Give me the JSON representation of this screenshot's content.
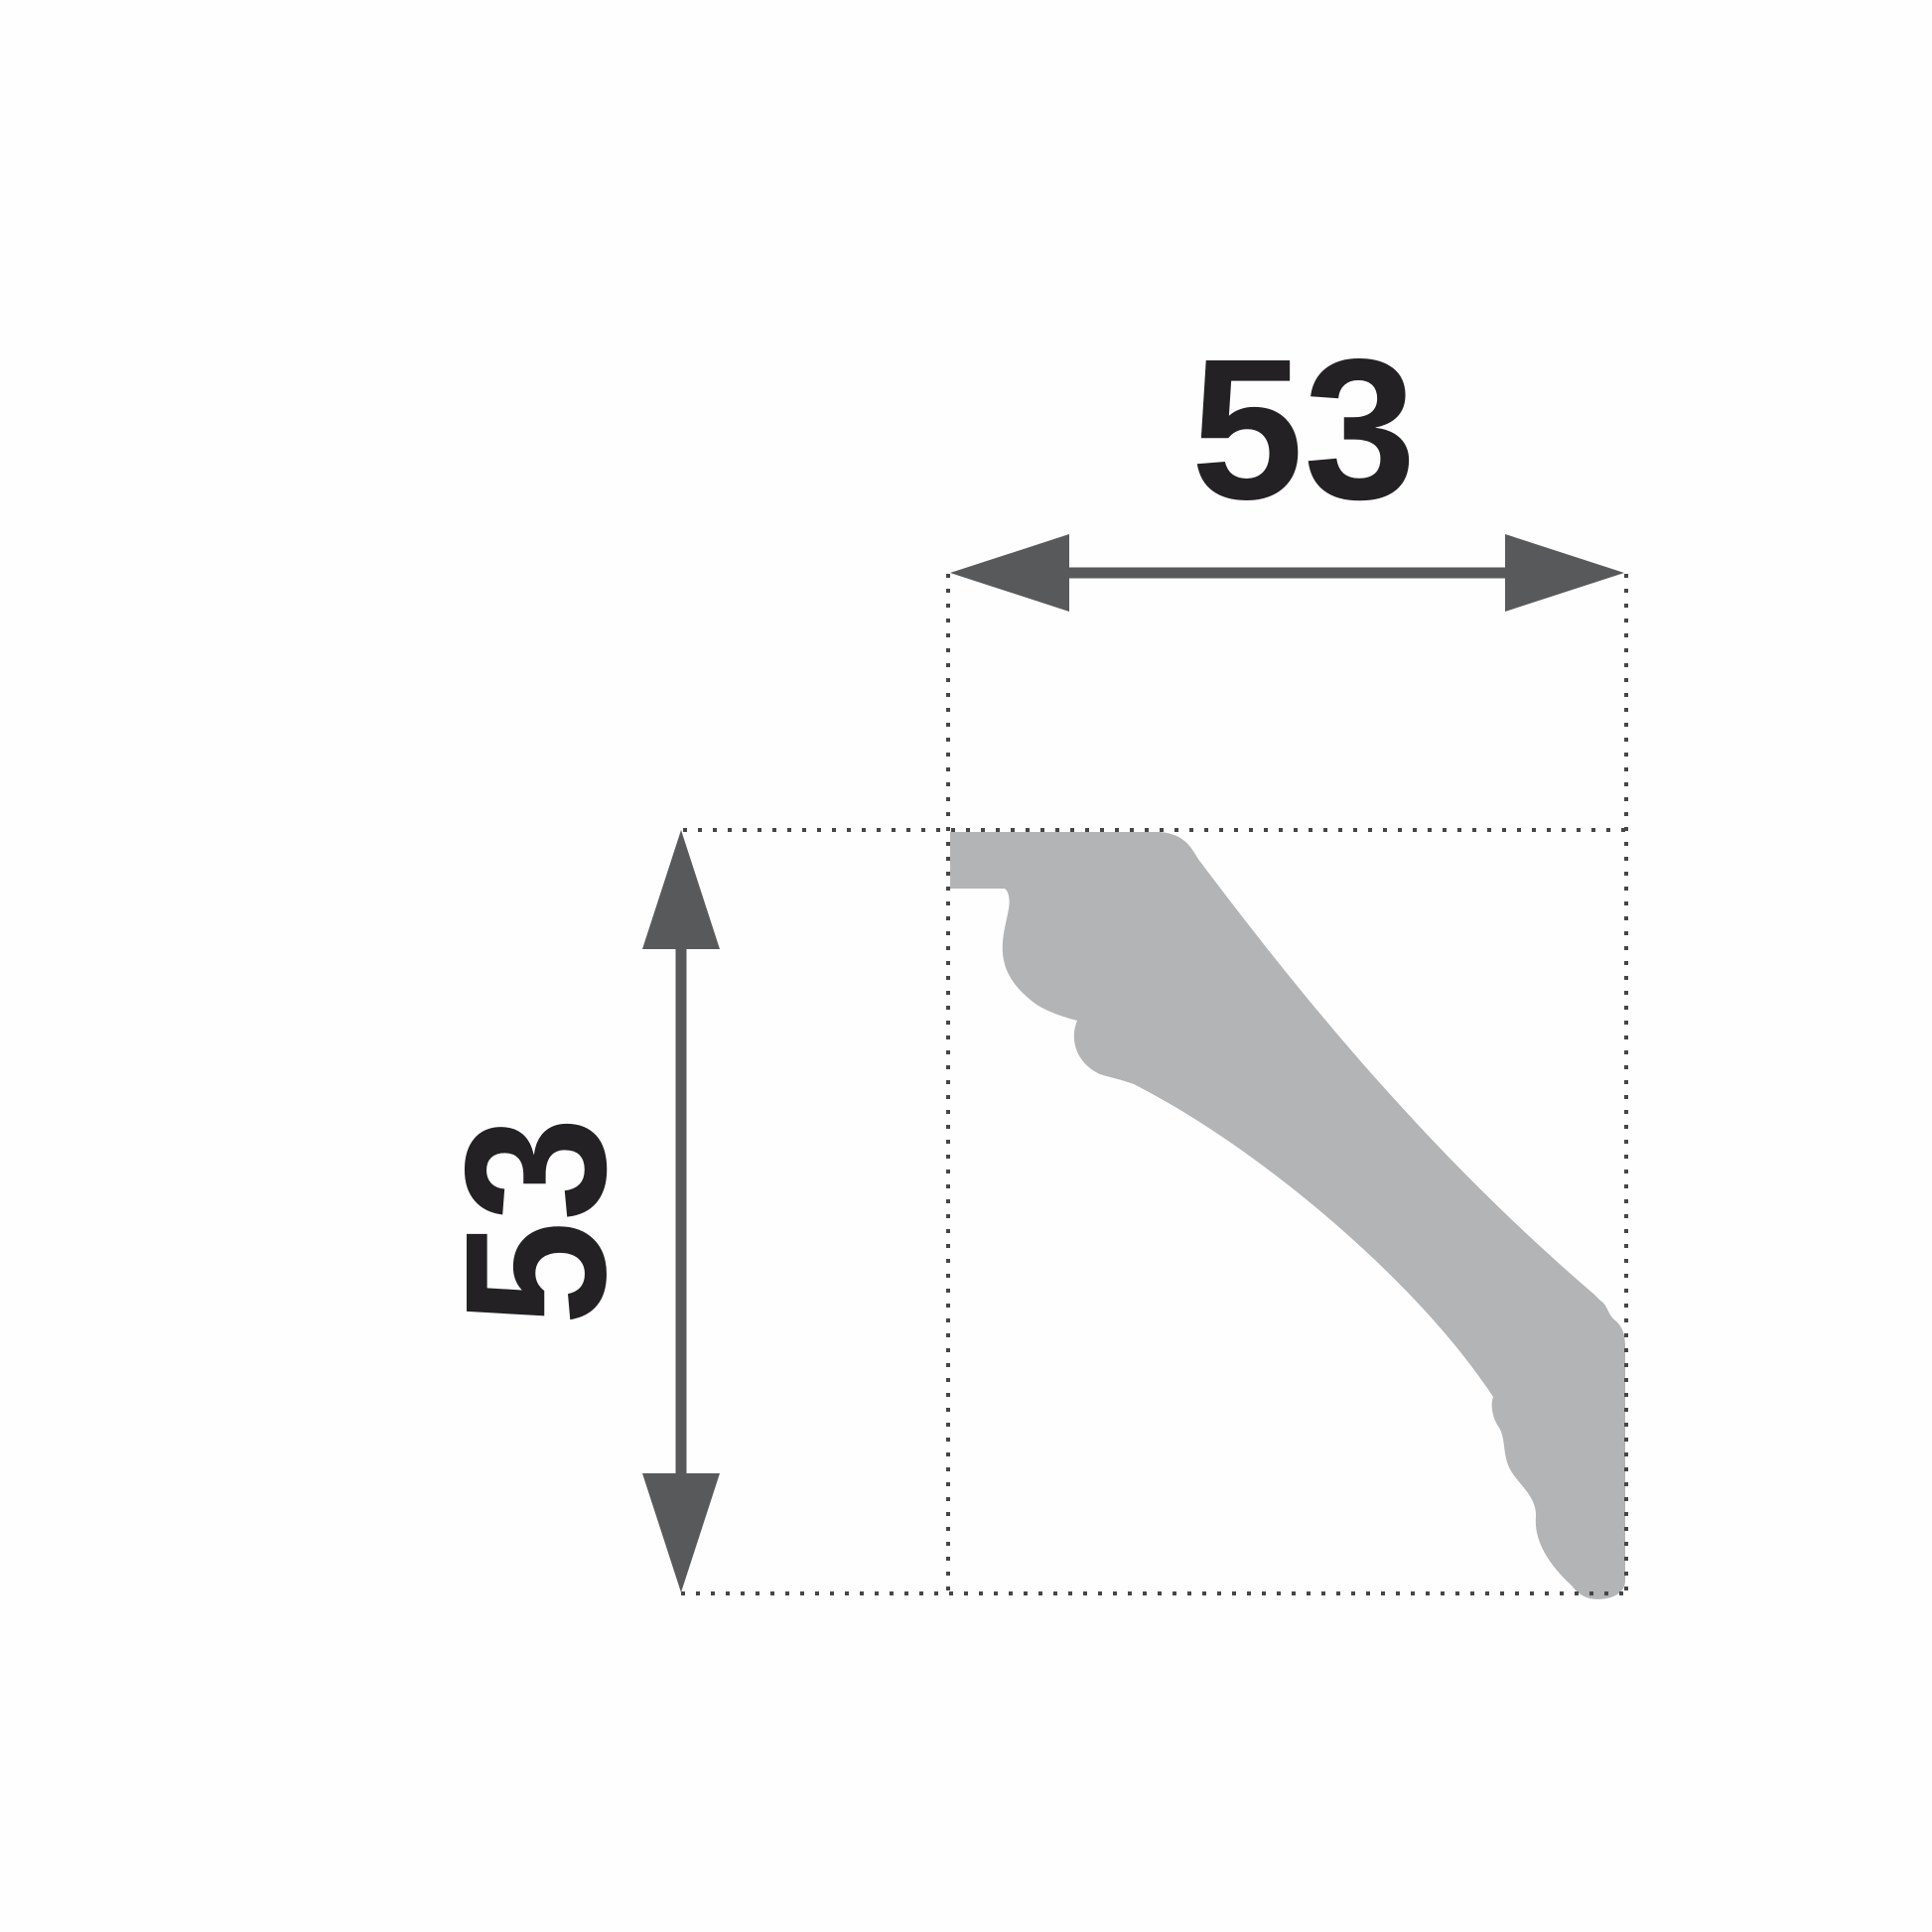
{
  "diagram": {
    "width_dimension": {
      "label": "53"
    },
    "height_dimension": {
      "label": "53"
    },
    "colors": {
      "background": "#fefefe",
      "profile_fill": "#b2b4b6",
      "dimension_color": "#58595b",
      "extension_line_color": "#454648",
      "label_color": "#232124"
    }
  }
}
